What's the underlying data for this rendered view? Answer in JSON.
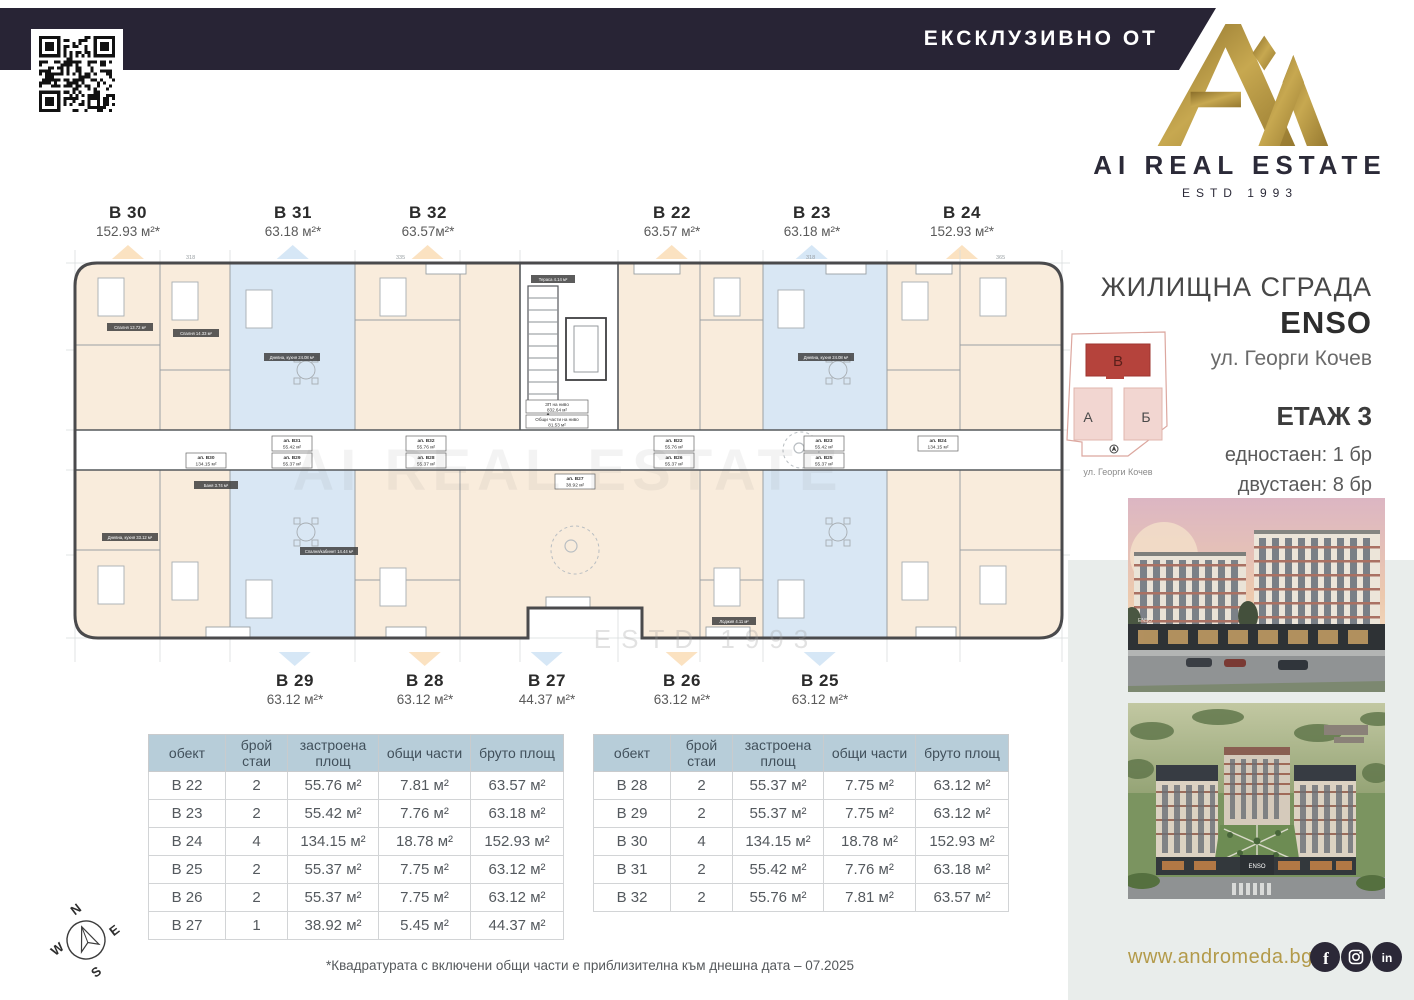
{
  "header": {
    "banner": "ЕКСКЛУЗИВНО ОТ"
  },
  "logo": {
    "title": "AI REAL ESTATE",
    "estd": "ESTD 1993"
  },
  "info": {
    "building_type": "ЖИЛИЩНА СГРАДА",
    "building_name": "ENSO",
    "address": "ул. Георги Кочев",
    "floor": "ЕТАЖ 3",
    "unit_counts": [
      "едностаен: 1 бр",
      "двустаен: 8 бр",
      "четиристаен: 2 бр"
    ]
  },
  "site_map": {
    "building_v": "В",
    "building_a": "А",
    "building_b": "Б",
    "caption": "ул. Георги Кочев"
  },
  "plan": {
    "level_mark": "+6.70",
    "watermark_big": "AI REAL ESTATE",
    "watermark": "ESTD 1993",
    "stair_note1_l1": "ЗП на ниво",
    "stair_note1_l2": "832.64 м²",
    "stair_note2_l1": "Общи части на ниво",
    "stair_note2_l2": "81.53 м²",
    "top_labels": [
      {
        "id": "В 30",
        "area": "152.93 м²*"
      },
      {
        "id": "В 31",
        "area": "63.18 м²*"
      },
      {
        "id": "В 32",
        "area": "63.57м²*"
      },
      {
        "id": "В 22",
        "area": "63.57 м²*"
      },
      {
        "id": "В 23",
        "area": "63.18 м²*"
      },
      {
        "id": "В 24",
        "area": "152.93 м²*"
      }
    ],
    "bottom_labels": [
      {
        "id": "В 29",
        "area": "63.12 м²*"
      },
      {
        "id": "В 28",
        "area": "63.12 м²*"
      },
      {
        "id": "В 27",
        "area": "44.37 м²*"
      },
      {
        "id": "В 26",
        "area": "63.12 м²*"
      },
      {
        "id": "В 25",
        "area": "63.12 м²*"
      }
    ],
    "unit_tags": [
      {
        "id": "ап. В31",
        "area": "55.42 м²"
      },
      {
        "id": "ап. В32",
        "area": "55.76 м²"
      },
      {
        "id": "ап. В22",
        "area": "55.76 м²"
      },
      {
        "id": "ап. В23",
        "area": "55.42 м²"
      },
      {
        "id": "ап. В24",
        "area": "134.15 м²"
      },
      {
        "id": "ап. В30",
        "area": "134.15 м²"
      },
      {
        "id": "ап. В29",
        "area": "55.37 м²"
      },
      {
        "id": "ап. В28",
        "area": "55.37 м²"
      },
      {
        "id": "ап. В27",
        "area": "38.92 м²"
      },
      {
        "id": "ап. В26",
        "area": "55.37 м²"
      },
      {
        "id": "ап. В25",
        "area": "55.37 м²"
      }
    ],
    "room_tags": [
      "Спалня 13.72 м²",
      "Спалня 14.33 м²",
      "Дневна, кухня 24.08 м²",
      "Дневна, кухня 24.08 м²",
      "Дневна, кухня 33.12 м²",
      "Спалня/кабинет 14.44 м²",
      "Баня 3.74 м²",
      "Тераса 4.14 м²",
      "Лоджия 4.11 м²"
    ],
    "dims": [
      "318",
      "335",
      "453",
      "318",
      "365",
      "222"
    ]
  },
  "tables": {
    "headers": [
      "обект",
      "брой стаи",
      "застроена площ",
      "общи части",
      "бруто площ"
    ],
    "left_rows": [
      [
        "В 22",
        "2",
        "55.76 м²",
        "7.81 м²",
        "63.57 м²"
      ],
      [
        "В 23",
        "2",
        "55.42 м²",
        "7.76 м²",
        "63.18 м²"
      ],
      [
        "В 24",
        "4",
        "134.15 м²",
        "18.78 м²",
        "152.93 м²"
      ],
      [
        "В 25",
        "2",
        "55.37 м²",
        "7.75 м²",
        "63.12 м²"
      ],
      [
        "В 26",
        "2",
        "55.37 м²",
        "7.75 м²",
        "63.12 м²"
      ],
      [
        "В 27",
        "1",
        "38.92 м²",
        "5.45 м²",
        "44.37 м²"
      ]
    ],
    "right_rows": [
      [
        "В 28",
        "2",
        "55.37 м²",
        "7.75 м²",
        "63.12 м²"
      ],
      [
        "В 29",
        "2",
        "55.37 м²",
        "7.75 м²",
        "63.12 м²"
      ],
      [
        "В 30",
        "4",
        "134.15 м²",
        "18.78 м²",
        "152.93 м²"
      ],
      [
        "В 31",
        "2",
        "55.42 м²",
        "7.76 м²",
        "63.18 м²"
      ],
      [
        "В 32",
        "2",
        "55.76 м²",
        "7.81 м²",
        "63.57 м²"
      ]
    ]
  },
  "footnote": "*Квадратурата с включени общи части е приблизителна към днешна дата – 07.2025",
  "footer": {
    "website": "www.andromeda.bg"
  },
  "photos": {
    "sign1": "ENSO",
    "sign2": "ENSO"
  },
  "compass": {
    "n": "N",
    "e": "E",
    "s": "S",
    "w": "W"
  }
}
